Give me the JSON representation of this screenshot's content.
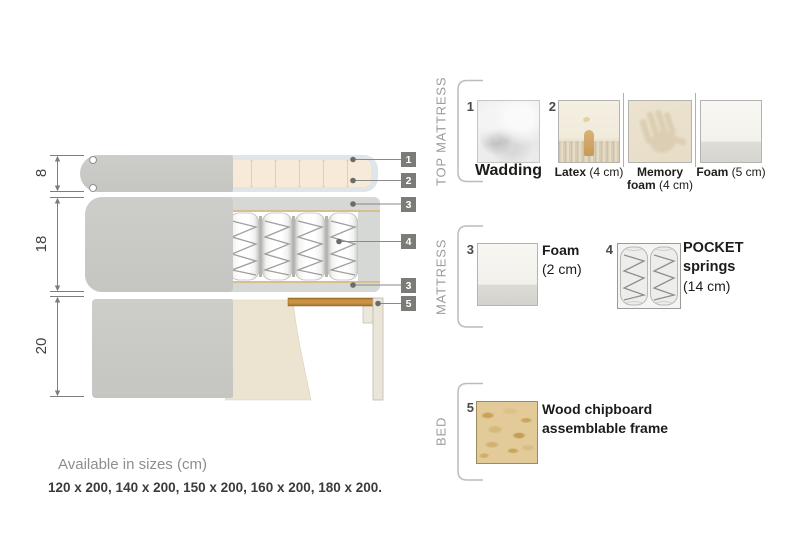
{
  "theme": {
    "callout_bg": "#7b7b78",
    "section_label_color": "#9c9c98",
    "footer_title_color": "#8e8e8a",
    "footer_sizes_color": "#3b3b39",
    "wood_color": "#c8913f"
  },
  "diagram": {
    "dimensions": [
      "8",
      "18",
      "20"
    ],
    "callouts": [
      "1",
      "2",
      "3",
      "4",
      "3",
      "5"
    ]
  },
  "legend": {
    "sections": [
      {
        "title": "TOP MATTRESS",
        "items": [
          {
            "num": "1",
            "name": "Wadding",
            "size": ""
          },
          {
            "num": "2",
            "name": "Latex",
            "size": "(4 cm)"
          },
          {
            "name1": "Memory",
            "name2": "foam",
            "size": "(4 cm)"
          },
          {
            "name": "Foam",
            "size": "(5 cm)"
          }
        ]
      },
      {
        "title": "MATTRESS",
        "items": [
          {
            "num": "3",
            "name": "Foam",
            "size": "(2 cm)"
          },
          {
            "num": "4",
            "name1": "POCKET",
            "name2": "springs",
            "size": "(14 cm)"
          }
        ]
      },
      {
        "title": "BED",
        "items": [
          {
            "num": "5",
            "name1": "Wood chipboard",
            "name2": "assemblable frame"
          }
        ]
      }
    ]
  },
  "footer": {
    "title": "Available in sizes (cm)",
    "sizes": "120 x 200, 140 x 200, 150 x 200, 160 x 200, 180 x 200."
  }
}
